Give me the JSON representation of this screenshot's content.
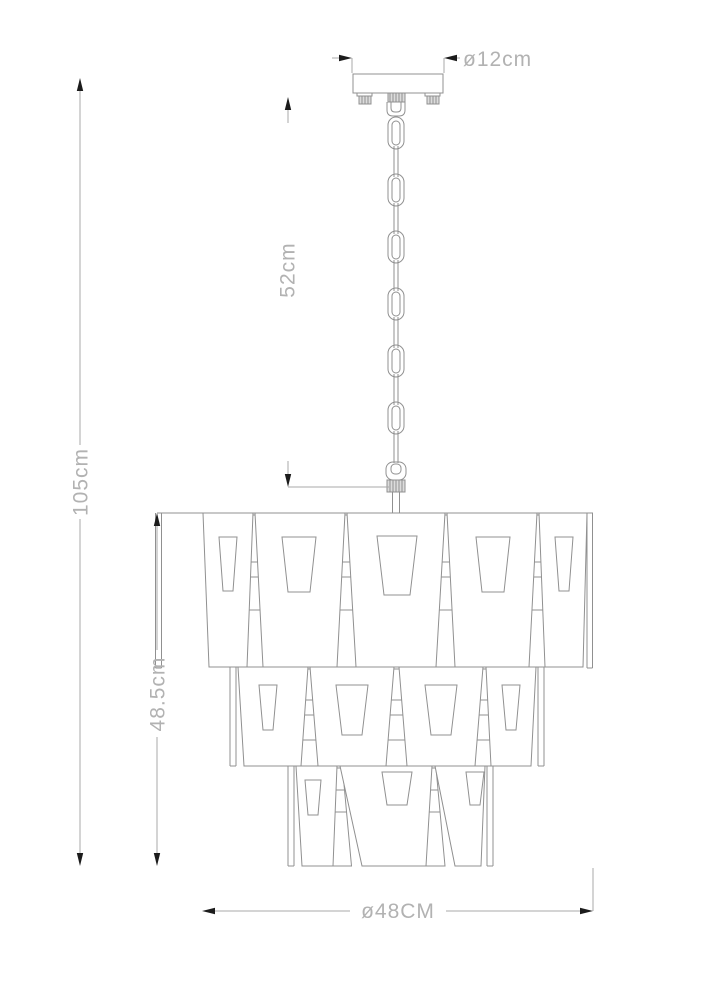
{
  "drawing": {
    "canopy_diameter_label": "ø12cm",
    "chain_length_label": "52cm",
    "total_height_label": "105cm",
    "body_height_label": "48.5cm",
    "body_diameter_label": "ø48CM"
  },
  "colors": {
    "background": "#ffffff",
    "drawing_line": "#909090",
    "dimension_line": "#a9a9a9",
    "arrowhead": "#1c1c1c",
    "label_text": "#b2b2b2"
  }
}
